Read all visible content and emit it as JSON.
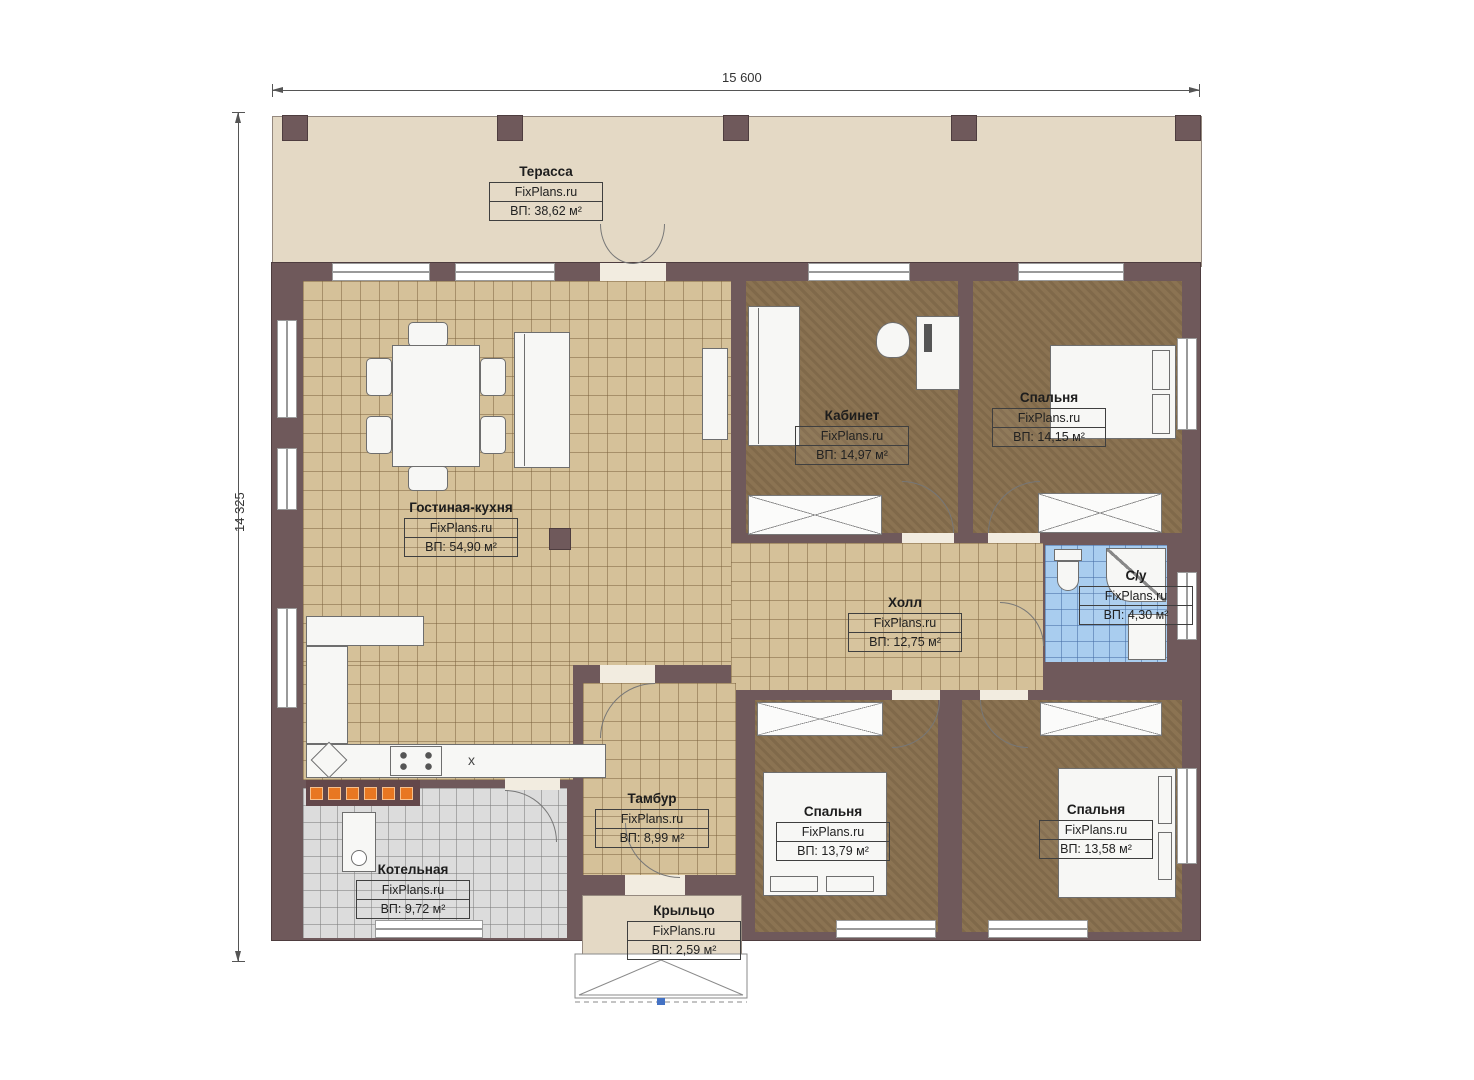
{
  "plan": {
    "watermark": "FixPlans.ru",
    "dimensions": {
      "width": "15 600",
      "height": "14 325"
    },
    "kitchen_mark": "x",
    "rooms": [
      {
        "id": "terrace",
        "name": "Терасса",
        "area": "ВП: 38,62 м²"
      },
      {
        "id": "living-kitchen",
        "name": "Гостиная-кухня",
        "area": "ВП: 54,90 м²"
      },
      {
        "id": "office",
        "name": "Кабинет",
        "area": "ВП: 14,97 м²"
      },
      {
        "id": "bedroom-1",
        "name": "Спальня",
        "area": "ВП: 14,15 м²"
      },
      {
        "id": "bathroom",
        "name": "С/у",
        "area": "ВП: 4,30 м²"
      },
      {
        "id": "hall",
        "name": "Холл",
        "area": "ВП: 12,75 м²"
      },
      {
        "id": "vestibule",
        "name": "Тамбур",
        "area": "ВП: 8,99 м²"
      },
      {
        "id": "bedroom-2",
        "name": "Спальня",
        "area": "ВП: 13,79 м²"
      },
      {
        "id": "bedroom-3",
        "name": "Спальня",
        "area": "ВП: 13,58 м²"
      },
      {
        "id": "boiler-room",
        "name": "Котельная",
        "area": "ВП: 9,72 м²"
      },
      {
        "id": "porch",
        "name": "Крыльцо",
        "area": "ВП: 2,59 м²"
      }
    ],
    "colors": {
      "wall": "#6F595B",
      "terrace_floor": "#E4D9C5",
      "wood_floor": "#D5C199",
      "carpet": "#8B7352",
      "bath_tile": "#A9CDEF",
      "boiler_tile": "#DBDBDB",
      "accent_orange": "#E87722"
    }
  }
}
